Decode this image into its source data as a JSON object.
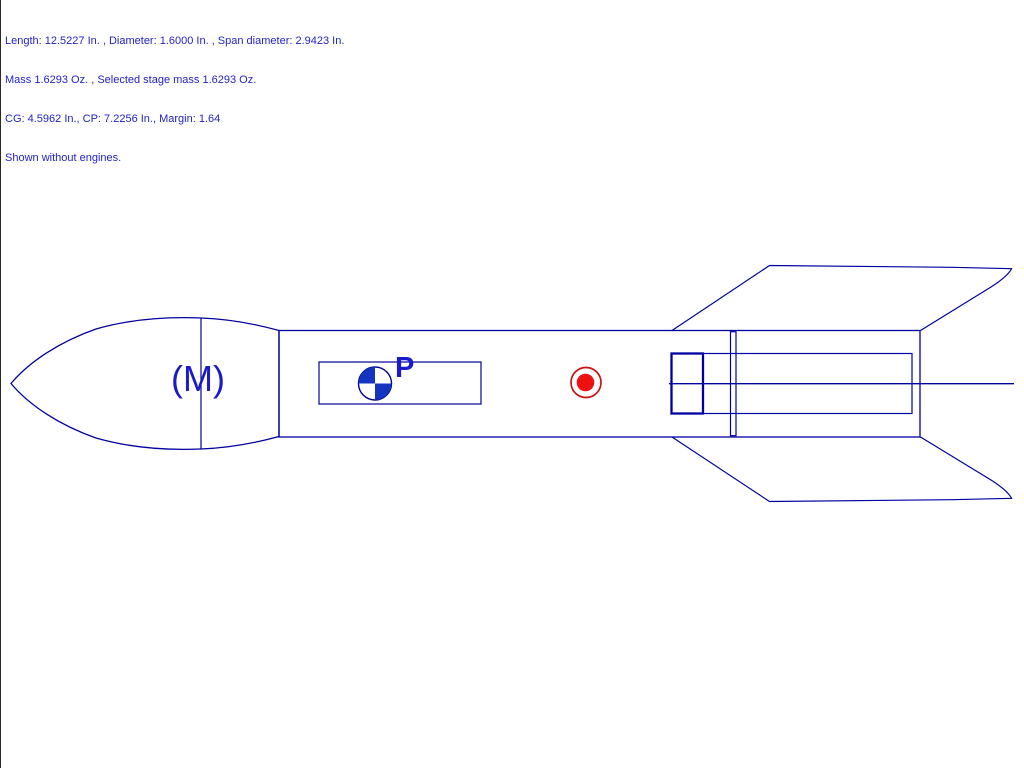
{
  "window": {
    "background_color": "#ffffff",
    "left_border_color": "#2a2a2a"
  },
  "info_panel": {
    "text_color": "#2222cc",
    "lines": [
      "Length: 12.5227 In. , Diameter: 1.6000 In. , Span diameter: 2.9423 In.",
      "Mass 1.6293 Oz. , Selected stage mass 1.6293 Oz.",
      "CG: 4.5962 In., CP: 7.2256 In., Margin: 1.64",
      "Shown without engines."
    ]
  },
  "canvas": {
    "outline_color": "#0000a0",
    "labels": {
      "nose_mass": "(M)",
      "cg_pod": "P"
    },
    "symbols": {
      "cg": {
        "name": "center-of-gravity",
        "fill_color": "#1535c0",
        "outline_color": "#000090"
      },
      "cp": {
        "name": "center-of-pressure",
        "ring_color": "#cc1111",
        "dot_color": "#ee1111"
      }
    }
  }
}
